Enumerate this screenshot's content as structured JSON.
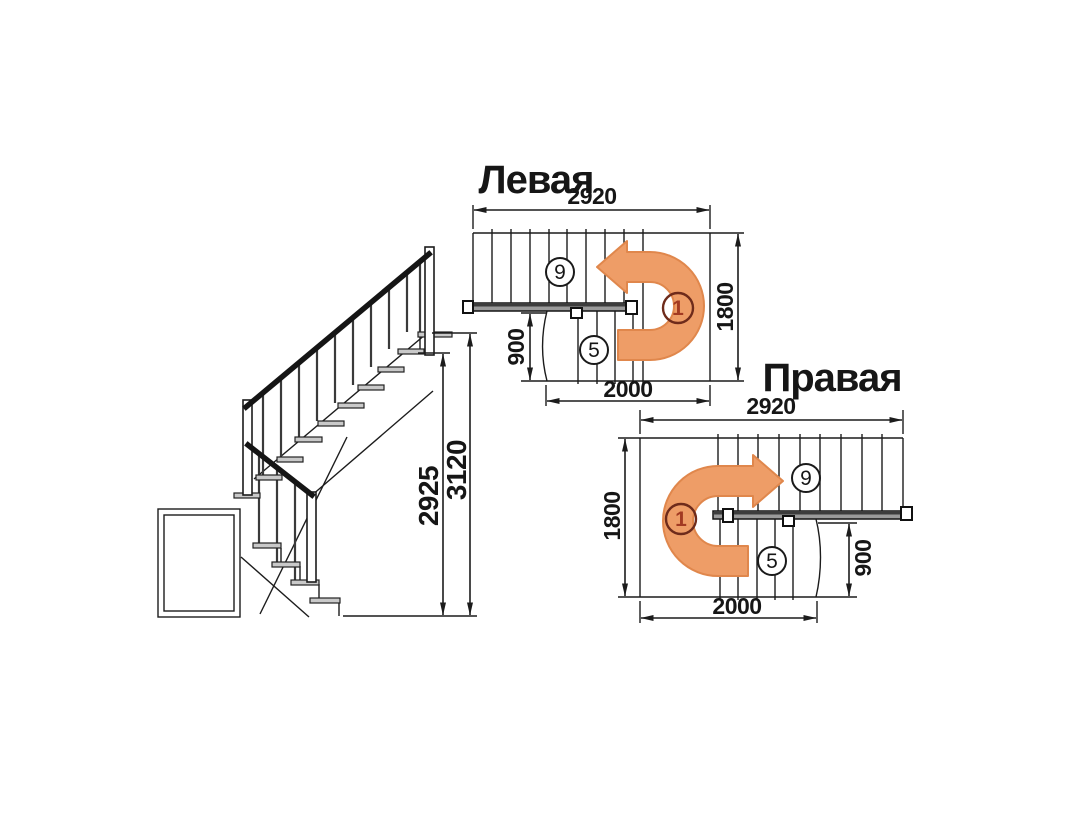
{
  "page": {
    "background": "#ffffff"
  },
  "elevation": {
    "label": "staircase side elevation",
    "dim_flight_height": "2925",
    "dim_total_height": "3120"
  },
  "plan_left": {
    "title": "Левая",
    "turn_direction": "counterclockwise",
    "dim_width": "2920",
    "dim_depth": "1800",
    "dim_lower_length": "2000",
    "dim_lower_width": "900",
    "upper_steps": "9",
    "turn_step": "1",
    "lower_steps": "5"
  },
  "plan_right": {
    "title": "Правая",
    "turn_direction": "clockwise",
    "dim_width": "2920",
    "dim_depth": "1800",
    "dim_lower_length": "2000",
    "dim_lower_width": "900",
    "upper_steps": "9",
    "turn_step": "1",
    "lower_steps": "5"
  },
  "colors": {
    "arrow_fill": "#EE9D67",
    "arrow_stroke": "#E0874C",
    "line": "#1c1c1c",
    "turn_number_red": "#A23A22",
    "turn_circle_stroke": "#6E2B1B",
    "tread_fill": "#c9c9c9",
    "handrail_bar": "#9a9a9a"
  }
}
